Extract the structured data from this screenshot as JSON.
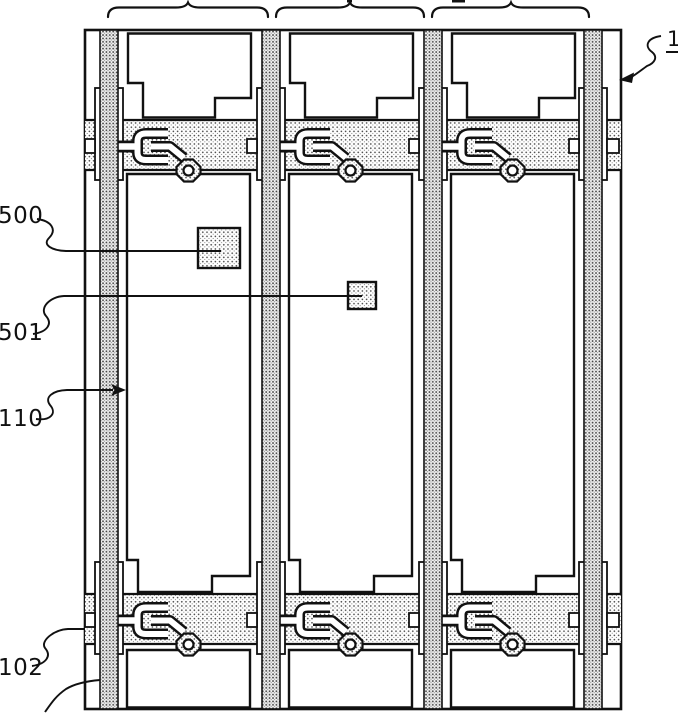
{
  "figure": {
    "description": "Patent drawing: plan view of a TFT array substrate with three pixel columns, two gate-line rows, data lines, thin-film transistors and storage capacitor pads",
    "labels": {
      "substrate": {
        "text": "1",
        "underlined": true
      },
      "storage_large": {
        "text": "500"
      },
      "storage_small": {
        "text": "501"
      },
      "data_line": {
        "text": "110"
      },
      "gate_line": {
        "text": "102"
      }
    },
    "colors": {
      "ink": "#111111",
      "paper": "#ffffff",
      "stipple_dot_dark": "#3c3c3c",
      "stipple_dot_light": "#4a4a4a"
    }
  }
}
